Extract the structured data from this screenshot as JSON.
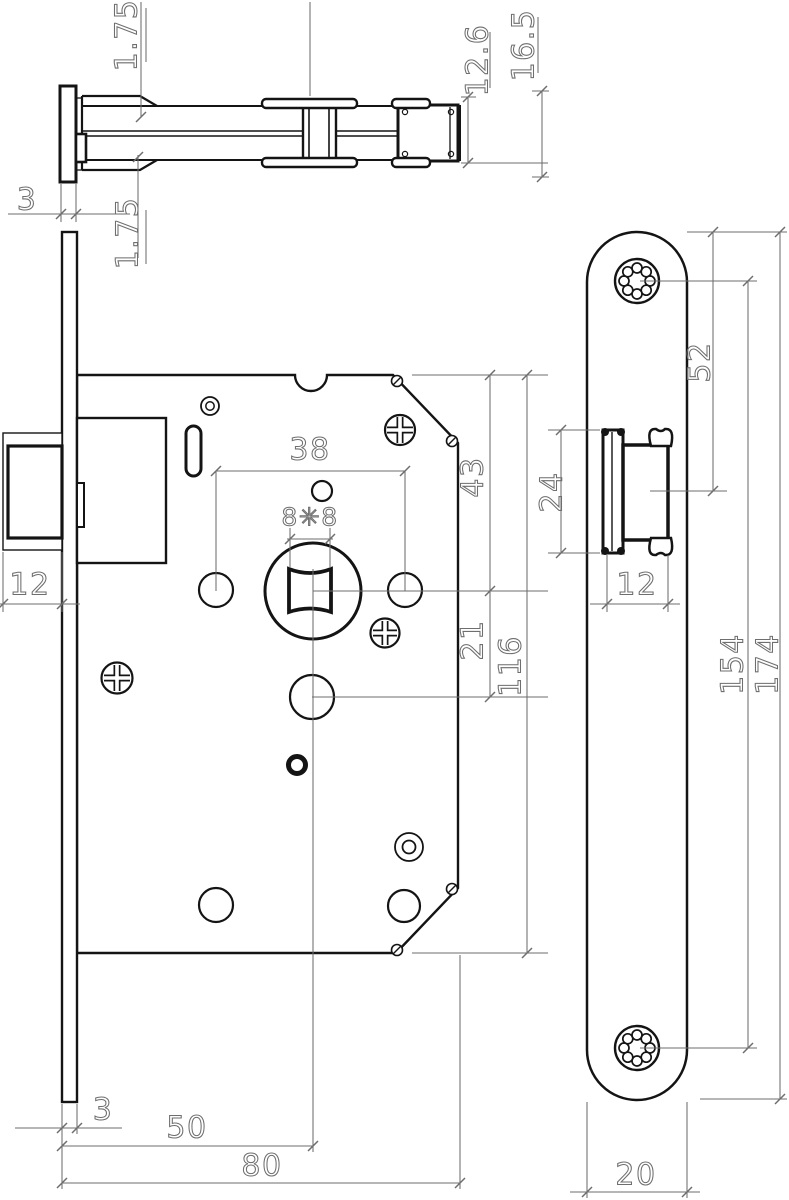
{
  "drawing": {
    "background": "#ffffff",
    "object_line_color": "#141414",
    "dimension_color": "#6e6e6e"
  },
  "dims": {
    "top": {
      "flange_top": "1.75",
      "flange_bottom": "1.75",
      "plate_thickness": "3",
      "latch_body_height": "12.6",
      "latch_total_height": "16.5"
    },
    "front": {
      "hole_spacing": "38",
      "spindle_square": "8✳8",
      "top_to_spindle": "43",
      "spindle_to_hole": "21",
      "case_height": "116",
      "bolt_height": "12",
      "plate_thickness": "3",
      "backset": "50",
      "case_depth": "80"
    },
    "side": {
      "top_to_latch": "52",
      "latch_cutout": "24",
      "latch_width": "12",
      "screw_centers": "154",
      "plate_length": "174",
      "plate_width": "20"
    }
  }
}
